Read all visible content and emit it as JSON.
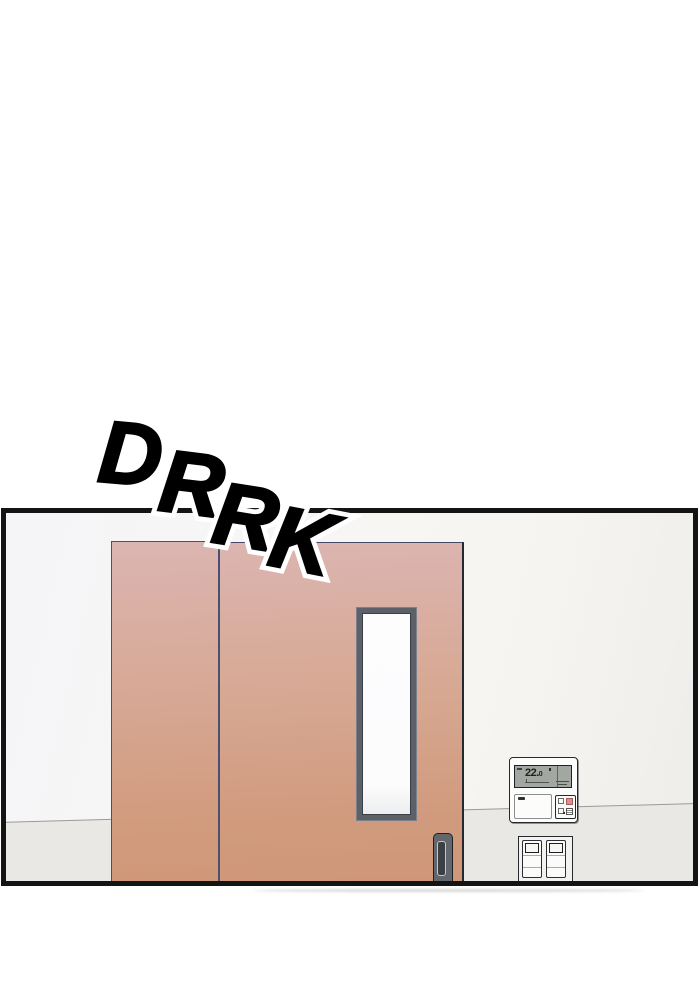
{
  "sfx": {
    "text": "DRRK",
    "letters": [
      "D",
      "R",
      "R",
      "K"
    ],
    "fill_color": "#000000",
    "outline_color": "#ffffff"
  },
  "panel": {
    "border_color": "#141414",
    "wall_color_left": "#f5f5f8",
    "wall_color_right": "#efedea",
    "floor_color": "#e9e8e5",
    "floor_line_color": "#9b9b97"
  },
  "door": {
    "top_color": "#dcb5b2",
    "bottom_color": "#cf9878",
    "edge_color": "#4b5070",
    "window_frame_color": "#5c6169",
    "window_glass_color": "#fdfdfe",
    "handle_body_color": "#63666c",
    "handle_slot_color": "#3c3f44"
  },
  "ac_panel": {
    "temperature": "22.",
    "temperature_decimal": "0",
    "body_color": "#fdfdfd",
    "display_color": "#a2a7a2",
    "display_text_color": "#1c1e20",
    "accent_button_color": "#de8e8b"
  },
  "light_switch": {
    "plate_color": "#f3f2f0",
    "outline_color": "#26282c"
  }
}
